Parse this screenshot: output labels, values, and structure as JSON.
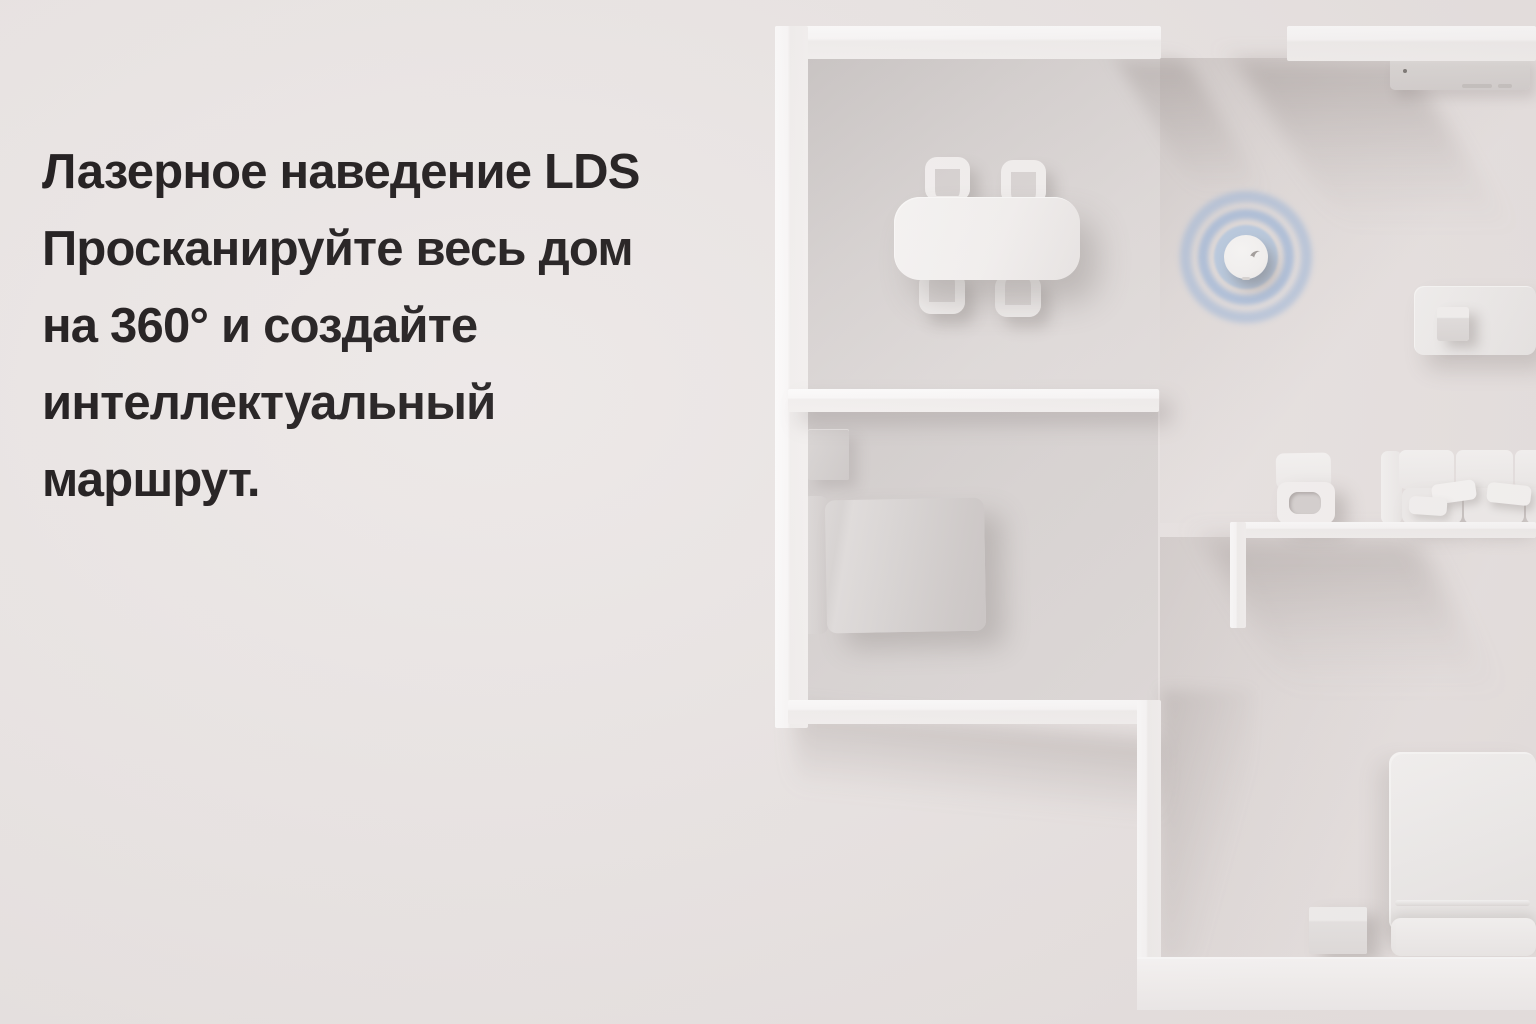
{
  "headline": {
    "lines": [
      "Лазерное наведение LDS",
      "Просканируйте весь дом",
      "на 360° и создайте",
      "интеллектуальный",
      "маршрут."
    ]
  },
  "colors": {
    "background": "#ebe6e5",
    "text": "#171314",
    "wall_bright": "#fdfcfc",
    "wall_face": "#f2efee",
    "furniture_light": "#f4f1f0",
    "floor_shade": "#cdc8c7",
    "radar_ring": "#93b1db",
    "radar_fill": "#a9c4e4",
    "robot_body": "#f6f4f3"
  },
  "scene": {
    "objects": [
      "robot-vacuum-with-lds-radar",
      "dining-table-with-four-chairs",
      "bed-with-headboard",
      "nightstand",
      "tv-console",
      "mat-with-cube",
      "stool-with-handle",
      "sofa-with-cushions",
      "vertical-bed-with-pillow",
      "storage-cube"
    ]
  }
}
